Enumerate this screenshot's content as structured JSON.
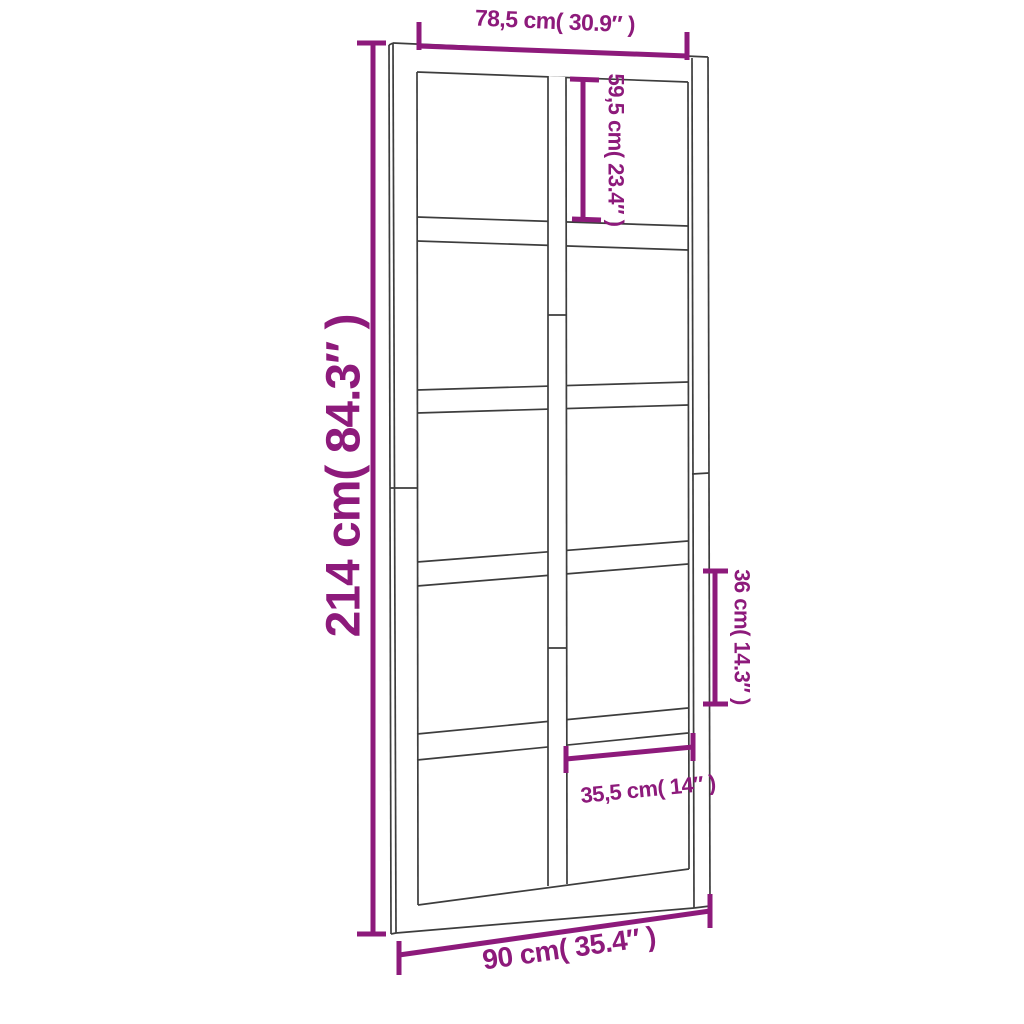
{
  "diagram": {
    "type": "product-dimension-diagram",
    "subject": "interior glazed door with 2 columns x 5 rows of panes, drawn in slight perspective",
    "colors": {
      "dimension_accent": "#8d1a7b",
      "outline": "#3d3d3d",
      "background": "#ffffff"
    },
    "door": {
      "pane_columns": 2,
      "pane_rows": 5,
      "pane_count": 10
    },
    "dimensions": {
      "top_width": "78,5 cm( 30.9″ )",
      "overall_height": "214 cm( 84.3″ )",
      "upper_pane_height": "59,5 cm( 23.4″ )",
      "lower_pane_height": "36 cm( 14.3″ )",
      "pane_width": "35,5 cm( 14″ )",
      "overall_width": "90 cm( 35.4″ )"
    }
  }
}
